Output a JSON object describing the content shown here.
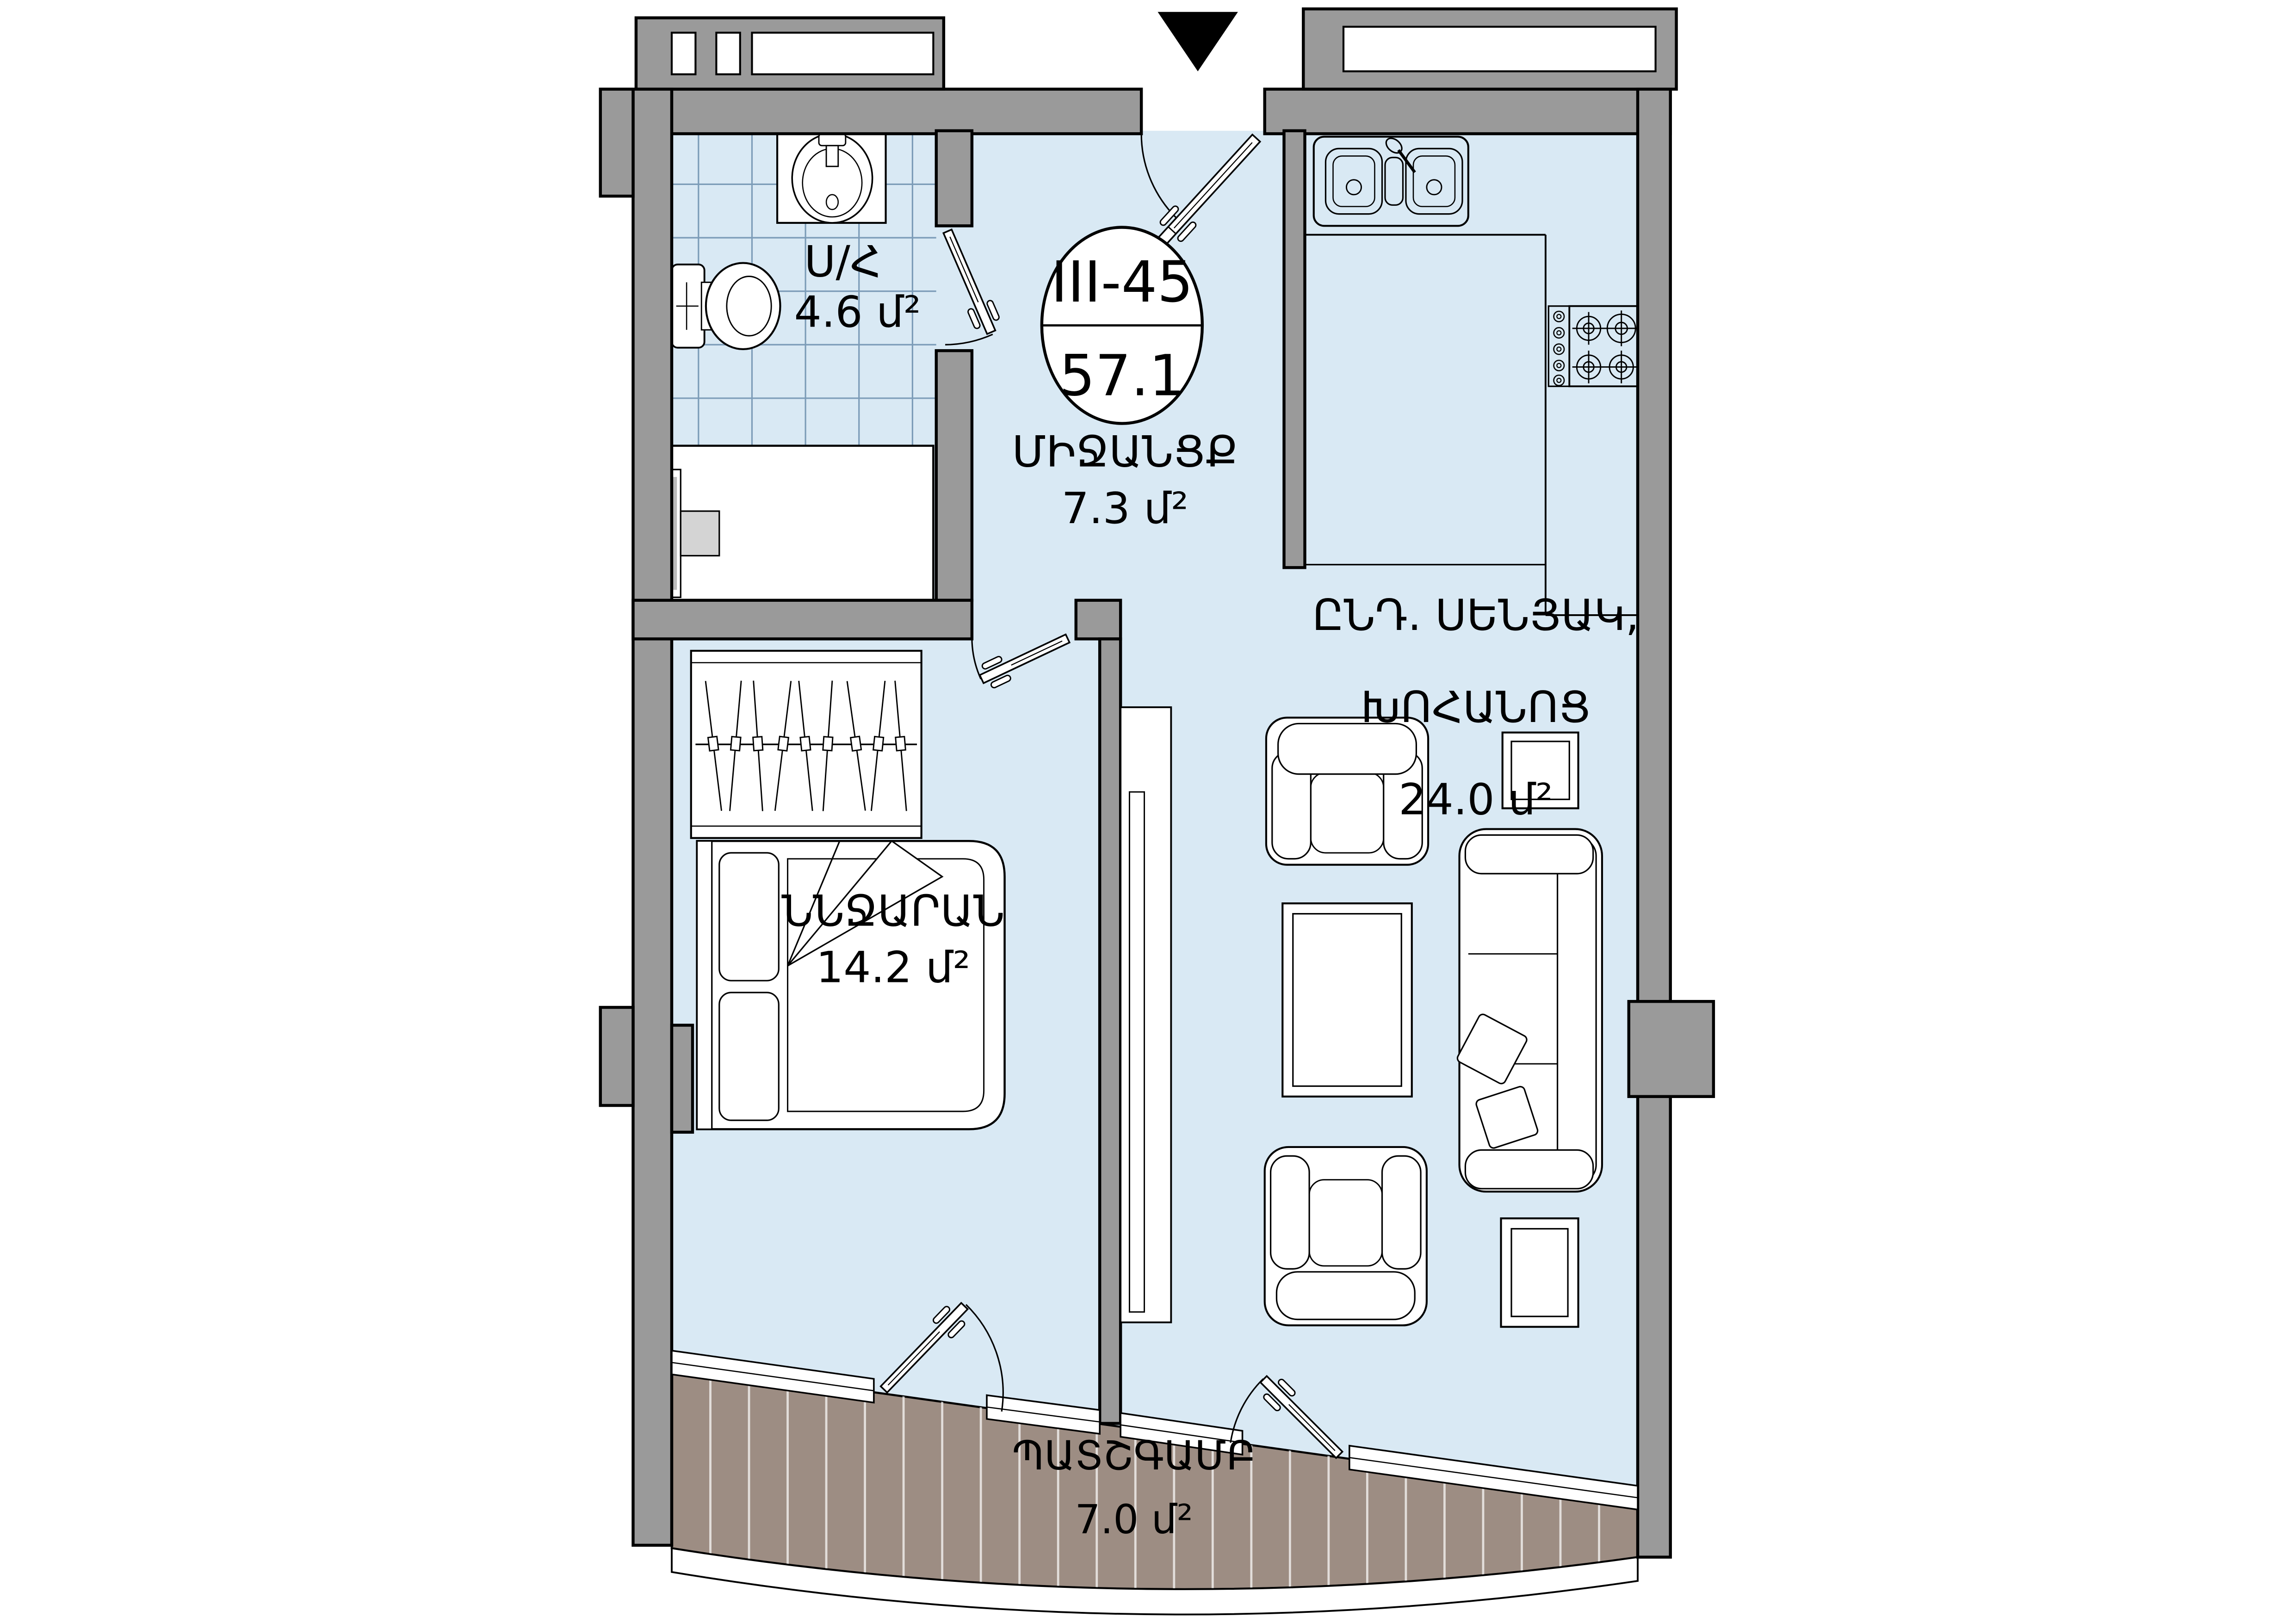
{
  "unit": {
    "code": "III-45",
    "total_area": "57.1"
  },
  "rooms": {
    "bathroom": {
      "name": "Ս/Հ",
      "area": "4.6 մ²"
    },
    "hallway": {
      "name": "ՄԻՋԱՆՑՔ",
      "area": "7.3 մ²"
    },
    "living": {
      "line1": "ԸՆԴ. ՍԵՆՅԱԿ,",
      "line2": "ԽՈՀԱՆՈՑ",
      "area": "24.0 մ²"
    },
    "bedroom": {
      "name": "ՆՆՋԱՐԱՆ",
      "area": "14.2 մ²"
    },
    "balcony": {
      "name": "ՊԱՏՇԳԱՄԲ",
      "area": "7.0 մ²"
    }
  },
  "colors": {
    "floor": "#d9e9f4",
    "tile_line": "#7c9cb8",
    "wall": "#9a9a9a",
    "deck": "#9d8d83",
    "outline": "#000000"
  }
}
